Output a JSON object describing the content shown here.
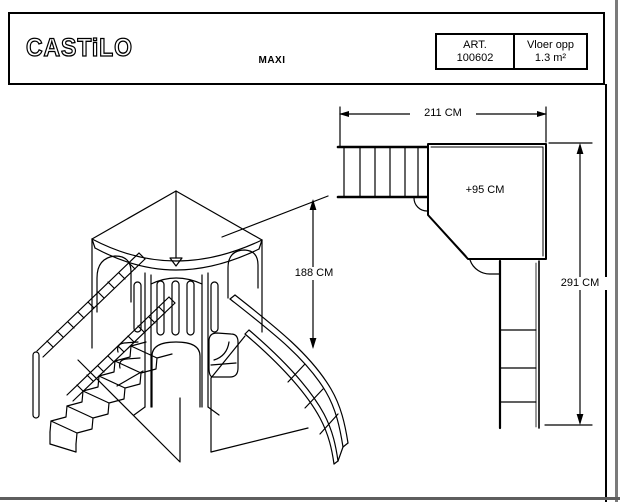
{
  "header": {
    "logo": "CASTiLO",
    "title": "MAXI",
    "art": {
      "label": "ART.",
      "value": "100602"
    },
    "floor": {
      "label": "Vloer opp",
      "value": "1.3 m²"
    }
  },
  "drawing": {
    "dim_width": "211 CM",
    "dim_platform_height": "+95 CM",
    "dim_height": "188 CM",
    "dim_length": "291 CM"
  },
  "colors": {
    "line": "#000000",
    "background": "#ffffff",
    "frame_gray": "#7a7a7a"
  }
}
